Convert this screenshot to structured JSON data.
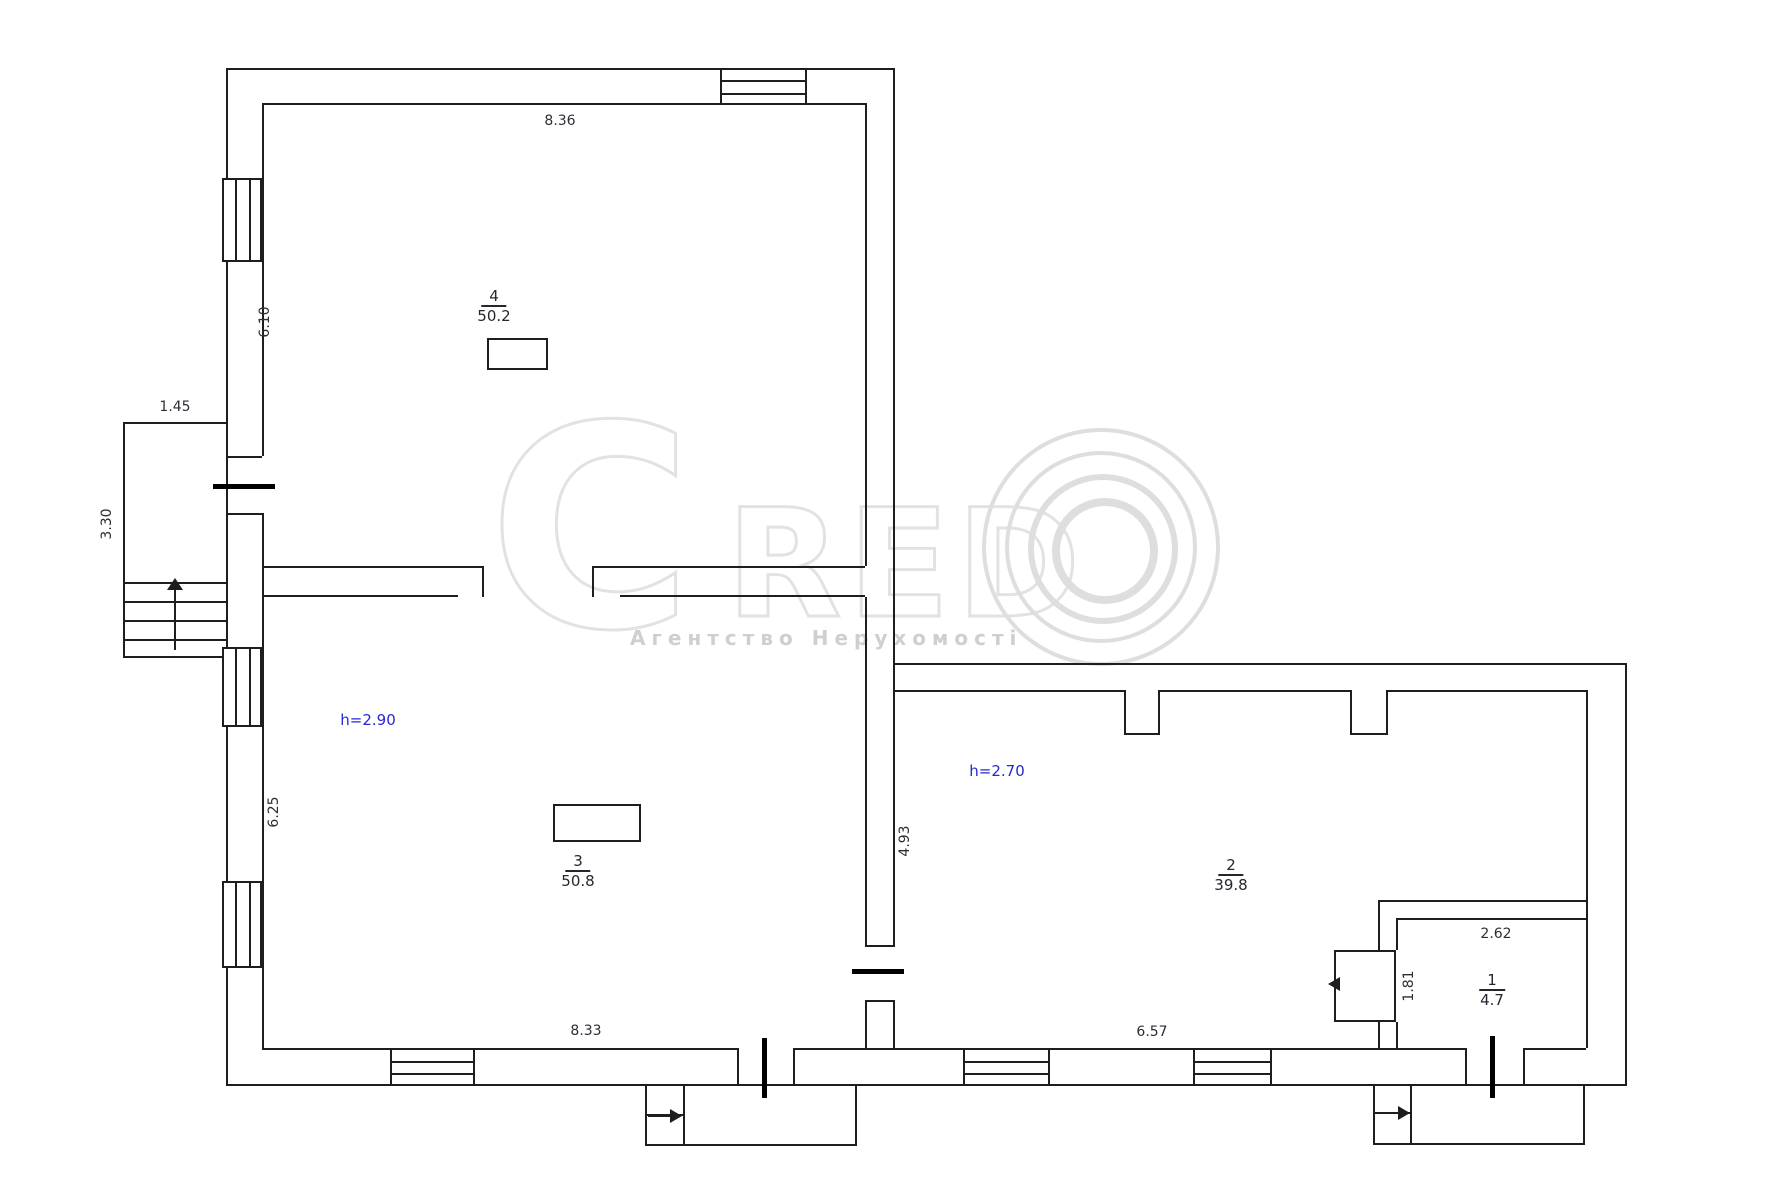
{
  "plan": {
    "watermark": {
      "letter_c": "C",
      "letters_red": "RED",
      "subtitle": "Агентство Нерухомості"
    },
    "rooms": {
      "r4": {
        "num": "4",
        "area": "50.2"
      },
      "r3": {
        "num": "3",
        "area": "50.8",
        "height_label": "h=2.90"
      },
      "r2": {
        "num": "2",
        "area": "39.8",
        "height_label": "h=2.70"
      },
      "r1": {
        "num": "1",
        "area": "4.7"
      }
    },
    "dims": {
      "room4_width": "8.36",
      "room4_height": "6.10",
      "porch_width": "1.45",
      "porch_height": "3.30",
      "room3_height": "6.25",
      "room3_width": "8.33",
      "room2_left_height": "4.93",
      "room2_width": "6.57",
      "room1_width": "2.62",
      "room1_height": "1.81"
    }
  }
}
